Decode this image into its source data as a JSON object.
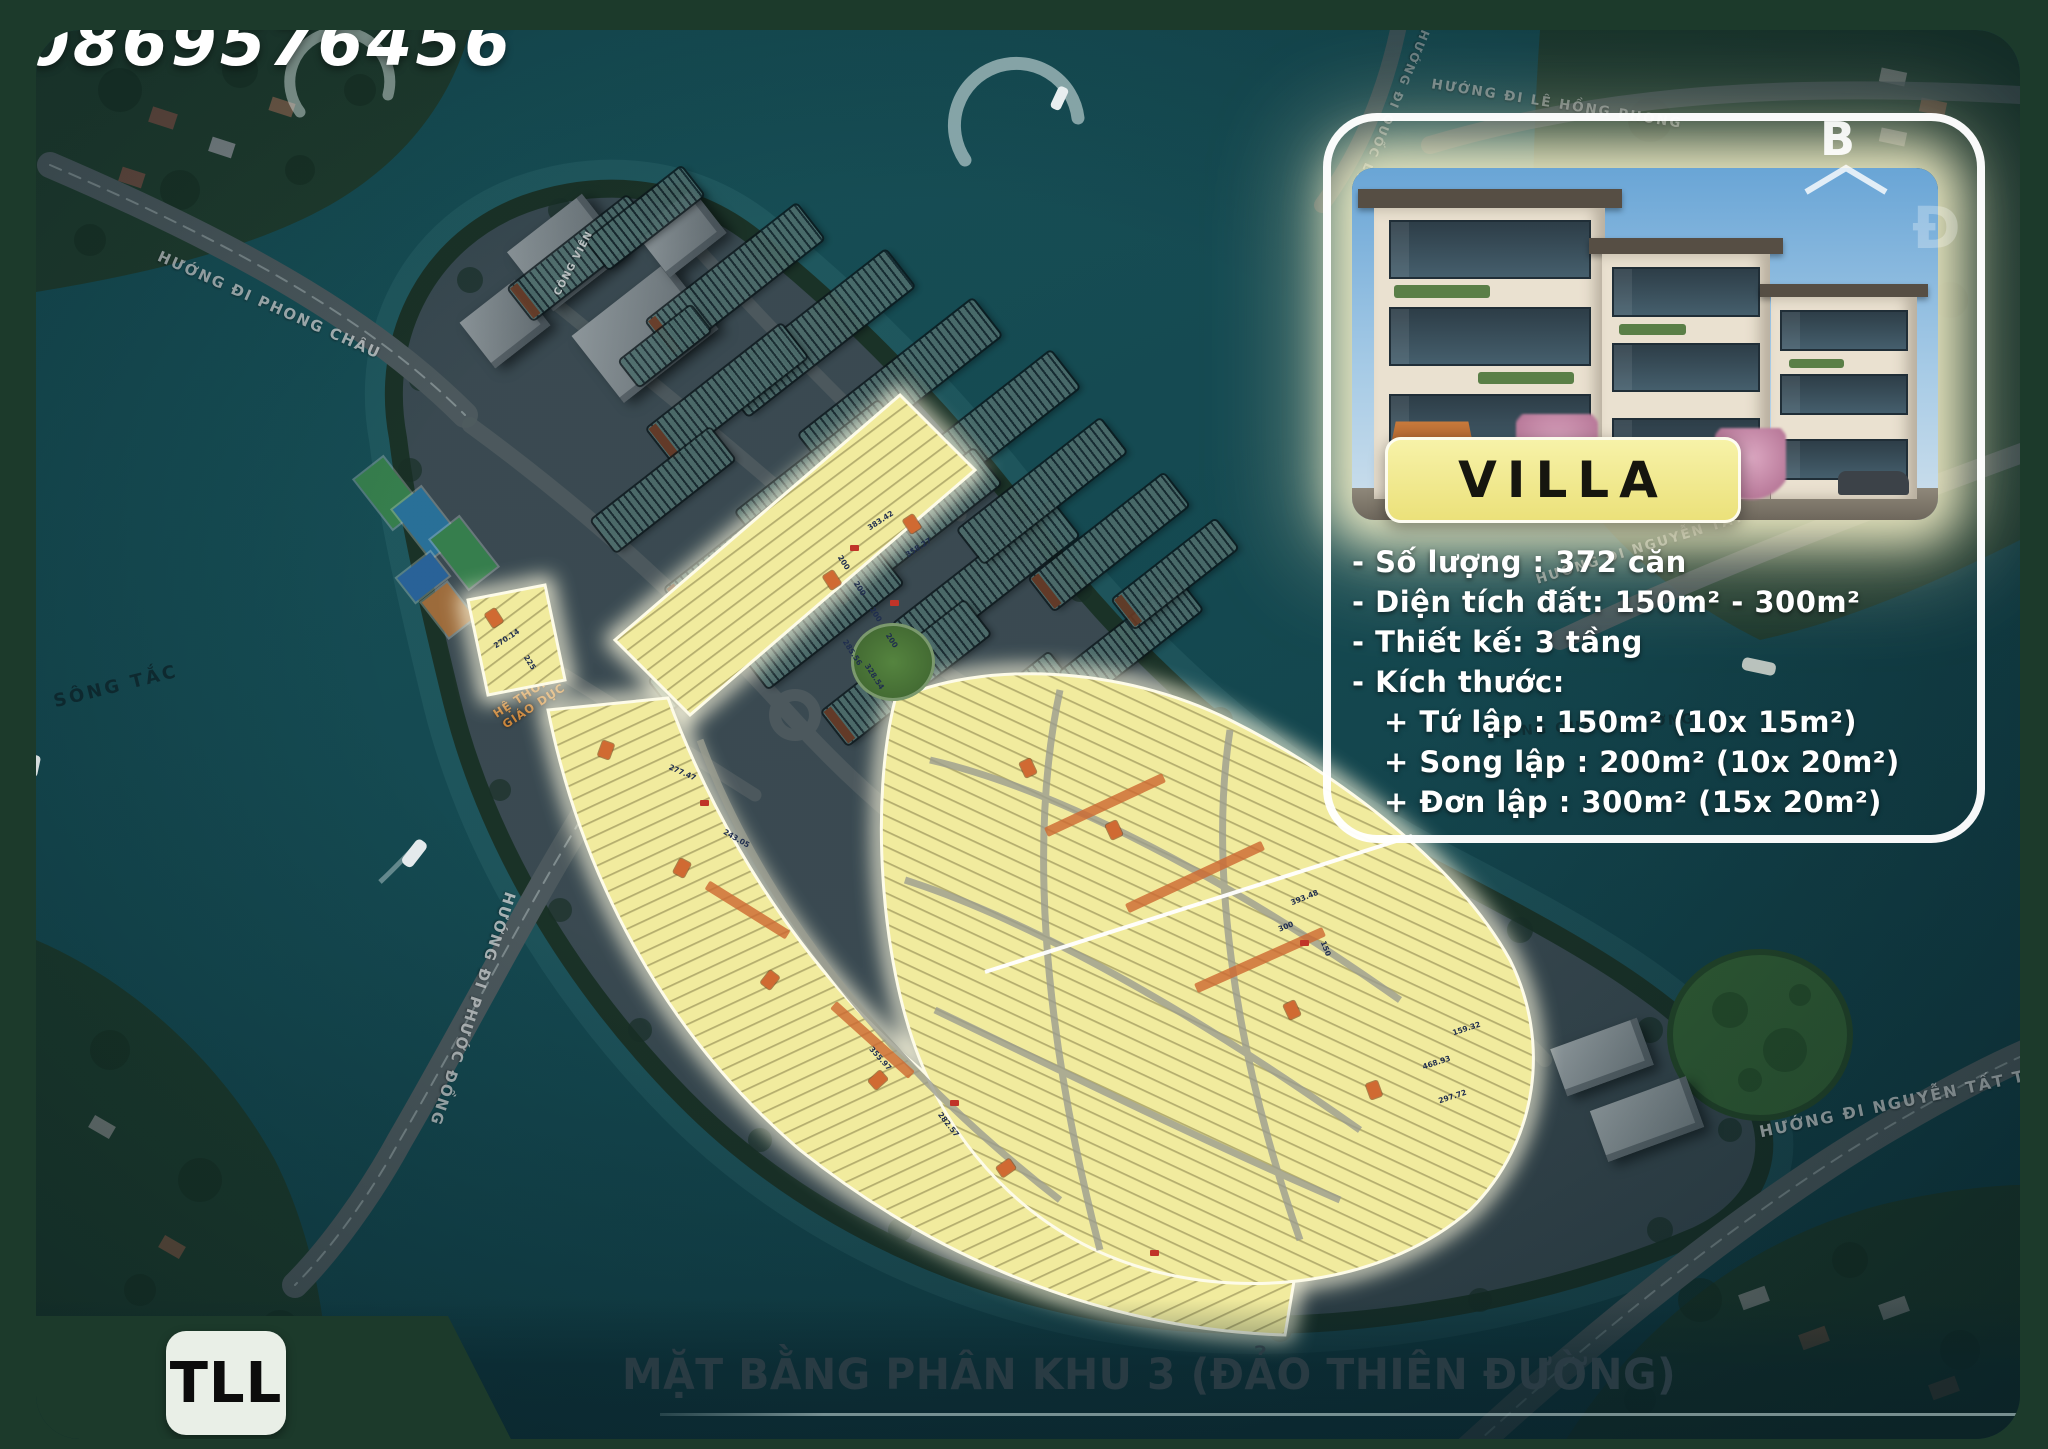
{
  "phone": "0869576456",
  "logo": "TLL",
  "title": "MẶT BẰNG PHÂN KHU 3 (ĐẢO THIÊN ĐƯỜNG)",
  "compass": {
    "letter": "B"
  },
  "villa_card": {
    "badge": "VILLA",
    "specs": [
      "- Số lượng : 372 căn",
      "- Diện tích đất: 150m² - 300m²",
      "- Thiết kế: 3 tầng",
      "- Kích thước:"
    ],
    "sizes": [
      "+  Tứ lập : 150m² (10x 15m²)",
      "+  Song lập : 200m² (10x 20m²)",
      "+  Đơn lập : 300m² (15x 20m²)"
    ]
  },
  "map_labels": {
    "road_phong_chau": "HƯỚNG ĐI PHONG CHÂU",
    "road_phuoc_dong": "HƯỚNG ĐI PHƯỚC ĐỒNG",
    "road_nguyen_tat_thanh_bottom": "HƯỚNG ĐI NGUYỄN TẤT THÀNH",
    "road_nguyen_tat_thanh_right": "HƯỚNG ĐI NGUYỄN TẤT THÀNH",
    "road_le_hong_phong": "HƯỚNG ĐI LÊ HỒNG PHONG",
    "road_quoc_lo": "HƯỚNG ĐI QUỐC LỘ",
    "river_song_tac": "SÔNG TẮC",
    "river_song_quan_truong": "SÔNG QUẢN TRƯỜNG",
    "park": "CÔNG VIÊN",
    "education_1": "HỆ THỐNG",
    "education_2": "GIÁO DỤC",
    "watermark_letter": "Đ"
  },
  "lot_values": [
    "383.42",
    "358.27",
    "200",
    "285.56",
    "328.54",
    "270.14",
    "225",
    "277.47",
    "243.05",
    "355.97",
    "282.57",
    "393.48",
    "300",
    "150",
    "468.93",
    "297.72",
    "159.32"
  ],
  "colors": {
    "frame_green": "#1c3a2b",
    "water_teal": "#17525a",
    "lot_yellow": "#f1eb9e",
    "lot_orange": "#d06a32",
    "badge_yellow": "#efe791",
    "card_border": "#ffffff"
  }
}
